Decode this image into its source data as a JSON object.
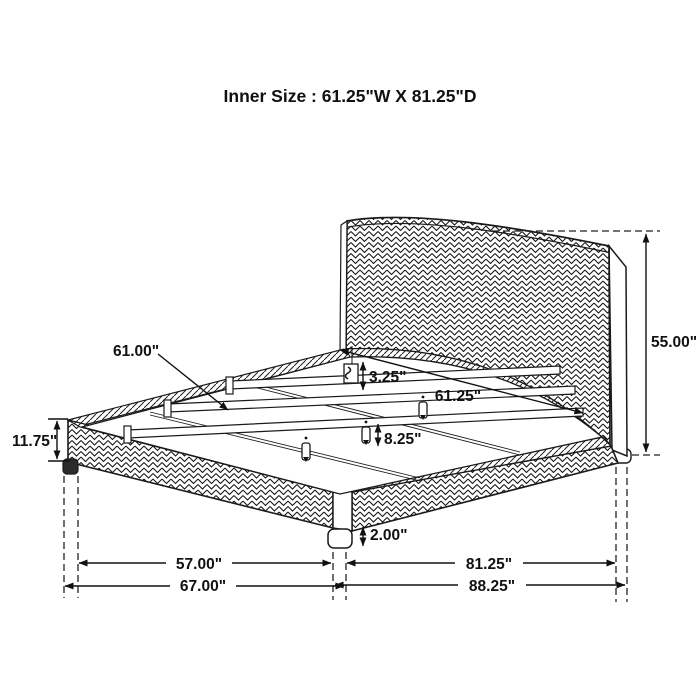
{
  "title": "Inner Size : 61.25\"W X 81.25\"D",
  "dimensions": {
    "slat_length": "61.00\"",
    "bracket_height": "3.25\"",
    "inner_width": "61.25\"",
    "headboard_height": "55.00\"",
    "rail_height": "11.75\"",
    "center_leg_height": "8.25\"",
    "foot_leg_height": "2.00\"",
    "leg_span_width": "57.00\"",
    "overall_width": "67.00\"",
    "inner_depth": "81.25\"",
    "overall_depth": "88.25\""
  },
  "colors": {
    "line": "#1a1a1a",
    "background": "#ffffff"
  }
}
